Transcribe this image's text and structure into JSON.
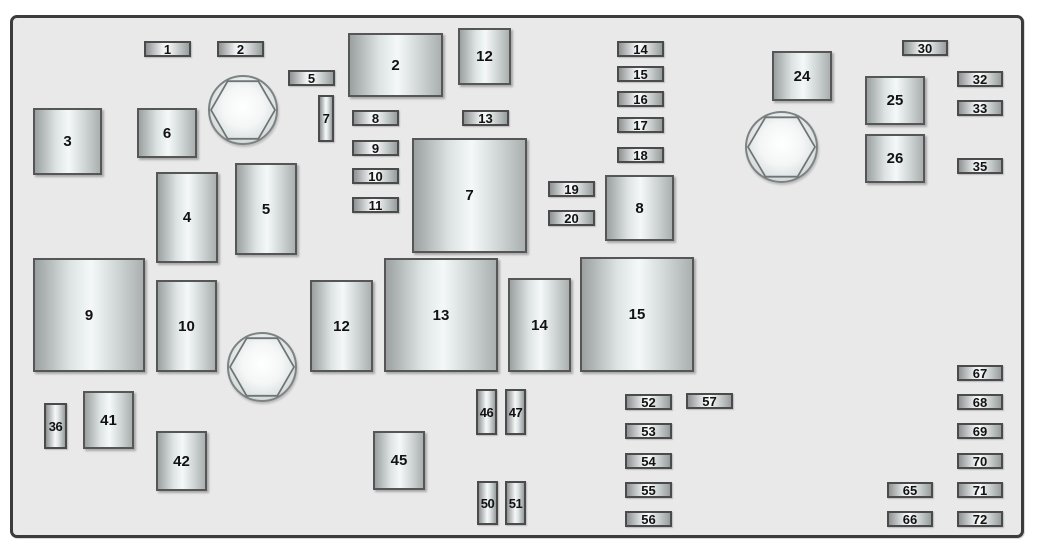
{
  "diagram": {
    "kind": "fuse-box-diagram",
    "page_background": "#ffffff",
    "panel_fill": "#e9e9e9",
    "panel_border_color": "#3c3c3c",
    "label_color": "#121212",
    "elements": [
      {
        "name": "fuse-1",
        "label": "1",
        "type": "fuse-h",
        "x": 144,
        "y": 41,
        "w": 47,
        "h": 16
      },
      {
        "name": "fuse-2",
        "label": "2",
        "type": "fuse-h",
        "x": 217,
        "y": 41,
        "w": 47,
        "h": 16
      },
      {
        "name": "relay-2",
        "label": "2",
        "type": "box",
        "x": 348,
        "y": 33,
        "w": 95,
        "h": 64
      },
      {
        "name": "relay-12-top",
        "label": "12",
        "type": "box",
        "x": 458,
        "y": 28,
        "w": 53,
        "h": 57
      },
      {
        "name": "fuse-5",
        "label": "5",
        "type": "fuse-h",
        "x": 288,
        "y": 70,
        "w": 47,
        "h": 16
      },
      {
        "name": "fuse-7",
        "label": "7",
        "type": "fuse-v",
        "x": 318,
        "y": 95,
        "w": 16,
        "h": 47
      },
      {
        "name": "box-3",
        "label": "3",
        "type": "box",
        "x": 33,
        "y": 108,
        "w": 69,
        "h": 67
      },
      {
        "name": "box-6",
        "label": "6",
        "type": "box",
        "x": 137,
        "y": 108,
        "w": 60,
        "h": 50
      },
      {
        "name": "hex-bolt-icon-top-left",
        "label": "",
        "type": "bolt",
        "x": 208,
        "y": 75,
        "w": 70,
        "h": 70
      },
      {
        "name": "fuse-8",
        "label": "8",
        "type": "fuse-h",
        "x": 352,
        "y": 110,
        "w": 47,
        "h": 16
      },
      {
        "name": "fuse-13",
        "label": "13",
        "type": "fuse-h",
        "x": 462,
        "y": 110,
        "w": 47,
        "h": 16
      },
      {
        "name": "fuse-9",
        "label": "9",
        "type": "fuse-h",
        "x": 352,
        "y": 140,
        "w": 47,
        "h": 16
      },
      {
        "name": "fuse-10",
        "label": "10",
        "type": "fuse-h",
        "x": 352,
        "y": 168,
        "w": 47,
        "h": 16
      },
      {
        "name": "fuse-11",
        "label": "11",
        "type": "fuse-h",
        "x": 352,
        "y": 197,
        "w": 47,
        "h": 16
      },
      {
        "name": "box-7-large",
        "label": "7",
        "type": "box",
        "x": 412,
        "y": 138,
        "w": 115,
        "h": 115
      },
      {
        "name": "fuse-14",
        "label": "14",
        "type": "fuse-h",
        "x": 617,
        "y": 41,
        "w": 47,
        "h": 16
      },
      {
        "name": "fuse-15",
        "label": "15",
        "type": "fuse-h",
        "x": 617,
        "y": 66,
        "w": 47,
        "h": 16
      },
      {
        "name": "fuse-16",
        "label": "16",
        "type": "fuse-h",
        "x": 617,
        "y": 91,
        "w": 47,
        "h": 16
      },
      {
        "name": "fuse-17",
        "label": "17",
        "type": "fuse-h",
        "x": 617,
        "y": 117,
        "w": 47,
        "h": 16
      },
      {
        "name": "fuse-18",
        "label": "18",
        "type": "fuse-h",
        "x": 617,
        "y": 147,
        "w": 47,
        "h": 16
      },
      {
        "name": "fuse-19",
        "label": "19",
        "type": "fuse-h",
        "x": 548,
        "y": 181,
        "w": 47,
        "h": 16
      },
      {
        "name": "fuse-20",
        "label": "20",
        "type": "fuse-h",
        "x": 548,
        "y": 210,
        "w": 47,
        "h": 16
      },
      {
        "name": "box-8-large",
        "label": "8",
        "type": "box",
        "x": 605,
        "y": 175,
        "w": 69,
        "h": 66
      },
      {
        "name": "relay-24",
        "label": "24",
        "type": "box",
        "x": 772,
        "y": 51,
        "w": 60,
        "h": 50
      },
      {
        "name": "hex-bolt-icon-top-right",
        "label": "",
        "type": "bolt",
        "x": 745,
        "y": 111,
        "w": 73,
        "h": 72
      },
      {
        "name": "relay-25",
        "label": "25",
        "type": "box",
        "x": 865,
        "y": 76,
        "w": 60,
        "h": 49
      },
      {
        "name": "relay-26",
        "label": "26",
        "type": "box",
        "x": 865,
        "y": 134,
        "w": 60,
        "h": 49
      },
      {
        "name": "fuse-30",
        "label": "30",
        "type": "fuse-h",
        "x": 902,
        "y": 40,
        "w": 46,
        "h": 16
      },
      {
        "name": "fuse-32",
        "label": "32",
        "type": "fuse-h",
        "x": 957,
        "y": 71,
        "w": 46,
        "h": 16
      },
      {
        "name": "fuse-33",
        "label": "33",
        "type": "fuse-h",
        "x": 957,
        "y": 100,
        "w": 46,
        "h": 16
      },
      {
        "name": "fuse-35",
        "label": "35",
        "type": "fuse-h",
        "x": 957,
        "y": 158,
        "w": 46,
        "h": 16
      },
      {
        "name": "box-4",
        "label": "4",
        "type": "box",
        "x": 156,
        "y": 172,
        "w": 62,
        "h": 91
      },
      {
        "name": "box-5",
        "label": "5",
        "type": "box",
        "x": 235,
        "y": 163,
        "w": 62,
        "h": 92
      },
      {
        "name": "box-9-large",
        "label": "9",
        "type": "box",
        "x": 33,
        "y": 258,
        "w": 112,
        "h": 114
      },
      {
        "name": "box-10",
        "label": "10",
        "type": "box",
        "x": 156,
        "y": 280,
        "w": 61,
        "h": 92
      },
      {
        "name": "hex-bolt-icon-bottom",
        "label": "",
        "type": "bolt",
        "x": 227,
        "y": 332,
        "w": 70,
        "h": 70
      },
      {
        "name": "box-12-mid",
        "label": "12",
        "type": "box",
        "x": 310,
        "y": 280,
        "w": 63,
        "h": 92
      },
      {
        "name": "box-13-large",
        "label": "13",
        "type": "box",
        "x": 384,
        "y": 258,
        "w": 114,
        "h": 114
      },
      {
        "name": "box-14-mid",
        "label": "14",
        "type": "box",
        "x": 508,
        "y": 278,
        "w": 63,
        "h": 94
      },
      {
        "name": "box-15-large",
        "label": "15",
        "type": "box",
        "x": 580,
        "y": 257,
        "w": 114,
        "h": 115
      },
      {
        "name": "fuse-36",
        "label": "36",
        "type": "fuse-v",
        "x": 44,
        "y": 403,
        "w": 23,
        "h": 46
      },
      {
        "name": "box-41",
        "label": "41",
        "type": "box",
        "x": 83,
        "y": 391,
        "w": 51,
        "h": 58
      },
      {
        "name": "box-42",
        "label": "42",
        "type": "box",
        "x": 156,
        "y": 431,
        "w": 51,
        "h": 60
      },
      {
        "name": "box-45",
        "label": "45",
        "type": "box",
        "x": 373,
        "y": 431,
        "w": 52,
        "h": 59
      },
      {
        "name": "fuse-46",
        "label": "46",
        "type": "fuse-v",
        "x": 476,
        "y": 389,
        "w": 21,
        "h": 46
      },
      {
        "name": "fuse-47",
        "label": "47",
        "type": "fuse-v",
        "x": 505,
        "y": 389,
        "w": 21,
        "h": 46
      },
      {
        "name": "fuse-50",
        "label": "50",
        "type": "fuse-v",
        "x": 477,
        "y": 481,
        "w": 21,
        "h": 44
      },
      {
        "name": "fuse-51",
        "label": "51",
        "type": "fuse-v",
        "x": 505,
        "y": 481,
        "w": 21,
        "h": 44
      },
      {
        "name": "fuse-52",
        "label": "52",
        "type": "fuse-h",
        "x": 625,
        "y": 394,
        "w": 47,
        "h": 16
      },
      {
        "name": "fuse-57",
        "label": "57",
        "type": "fuse-h",
        "x": 686,
        "y": 393,
        "w": 47,
        "h": 16
      },
      {
        "name": "fuse-53",
        "label": "53",
        "type": "fuse-h",
        "x": 625,
        "y": 423,
        "w": 47,
        "h": 16
      },
      {
        "name": "fuse-54",
        "label": "54",
        "type": "fuse-h",
        "x": 625,
        "y": 453,
        "w": 47,
        "h": 16
      },
      {
        "name": "fuse-55",
        "label": "55",
        "type": "fuse-h",
        "x": 625,
        "y": 482,
        "w": 47,
        "h": 16
      },
      {
        "name": "fuse-56",
        "label": "56",
        "type": "fuse-h",
        "x": 625,
        "y": 511,
        "w": 47,
        "h": 16
      },
      {
        "name": "fuse-65",
        "label": "65",
        "type": "fuse-h",
        "x": 887,
        "y": 482,
        "w": 46,
        "h": 16
      },
      {
        "name": "fuse-66",
        "label": "66",
        "type": "fuse-h",
        "x": 887,
        "y": 511,
        "w": 46,
        "h": 16
      },
      {
        "name": "fuse-67",
        "label": "67",
        "type": "fuse-h",
        "x": 957,
        "y": 365,
        "w": 46,
        "h": 16
      },
      {
        "name": "fuse-68",
        "label": "68",
        "type": "fuse-h",
        "x": 957,
        "y": 394,
        "w": 46,
        "h": 16
      },
      {
        "name": "fuse-69",
        "label": "69",
        "type": "fuse-h",
        "x": 957,
        "y": 423,
        "w": 46,
        "h": 16
      },
      {
        "name": "fuse-70",
        "label": "70",
        "type": "fuse-h",
        "x": 957,
        "y": 453,
        "w": 46,
        "h": 16
      },
      {
        "name": "fuse-71",
        "label": "71",
        "type": "fuse-h",
        "x": 957,
        "y": 482,
        "w": 46,
        "h": 16
      },
      {
        "name": "fuse-72",
        "label": "72",
        "type": "fuse-h",
        "x": 957,
        "y": 511,
        "w": 46,
        "h": 16
      }
    ]
  }
}
